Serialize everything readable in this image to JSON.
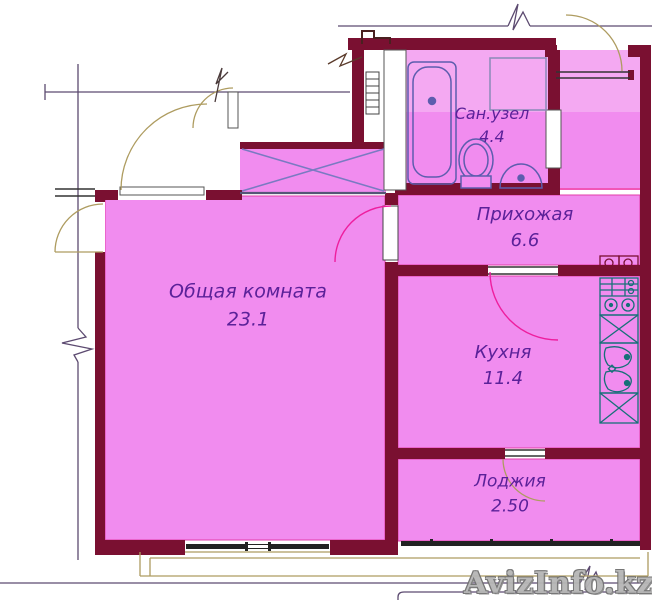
{
  "title": "Apartment floor plan",
  "watermark": {
    "text": "AvizInfo.kz"
  },
  "rooms": [
    {
      "id": "living-room",
      "name": "Общая комната",
      "area": "23.1"
    },
    {
      "id": "hallway",
      "name": "Прихожая",
      "area": "6.6"
    },
    {
      "id": "bathroom",
      "name": "Сан.узел",
      "area": "4.4"
    },
    {
      "id": "kitchen",
      "name": "Кухня",
      "area": "11.4"
    },
    {
      "id": "loggia",
      "name": "Лоджия",
      "area": "2.50"
    }
  ],
  "fixtures": [
    "bathtub",
    "toilet",
    "wash-basin",
    "washing-machine-box",
    "stove-4-burner",
    "kitchen-double-sink",
    "cabinet-x-2",
    "vent-shaft-x-box",
    "duct-ladder"
  ],
  "colors": {
    "room_fill": "#f18cef",
    "room_fill_light": "#f7bdf4",
    "wall": "#7a1031",
    "magenta_line": "#ee1e9e",
    "fixture_blue": "#5d5dae",
    "fixture_teal": "#177078",
    "x_diagonal": "#7a7ac2",
    "door_arc_tan": "#ae9c60",
    "outline_purple": "#5c4a70",
    "window_black": "#222222",
    "label_text": "#5b2199",
    "watermark_gray": "#b6b6b6"
  }
}
